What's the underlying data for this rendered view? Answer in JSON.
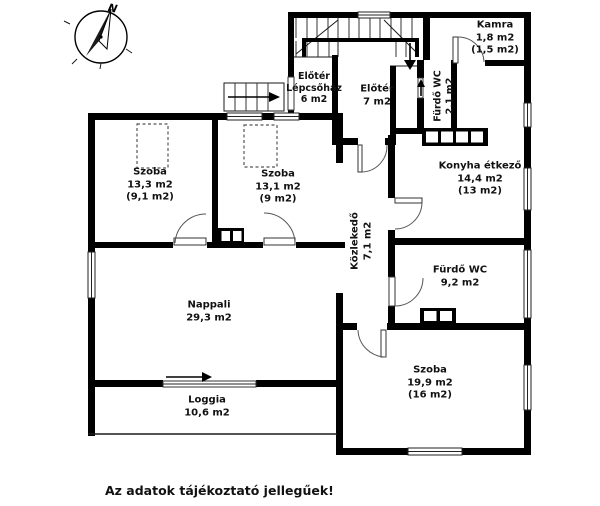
{
  "plan": {
    "compass": {
      "north_label": "N"
    },
    "rooms": {
      "szoba_133": {
        "name": "Szoba",
        "area": "13,3 m2",
        "reduced": "(9,1 m2)"
      },
      "szoba_131": {
        "name": "Szoba",
        "area": "13,1 m2",
        "reduced": "(9 m2)"
      },
      "eloter_lepcsohaz": {
        "name1": "Előtér",
        "name2": "Lépcsőház",
        "area": "6 m2"
      },
      "eloter": {
        "name": "Előtér",
        "area": "7 m2"
      },
      "kamra": {
        "name": "Kamra",
        "area": "1,8 m2",
        "reduced": "(1,5 m2)"
      },
      "furdo_wc_kis": {
        "name": "Fürdő WC",
        "area": "2,1 m2"
      },
      "konyha": {
        "name": "Konyha étkező",
        "area": "14,4 m2",
        "reduced": "(13 m2)"
      },
      "kozlekedo": {
        "name": "Közlekedő",
        "area": "7,1 m2"
      },
      "furdo_wc": {
        "name": "Fürdő WC",
        "area": "9,2 m2"
      },
      "nappali": {
        "name": "Nappali",
        "area": "29,3 m2"
      },
      "loggia": {
        "name": "Loggia",
        "area": "10,6 m2"
      },
      "szoba_199": {
        "name": "Szoba",
        "area": "19,9 m2",
        "reduced": "(16 m2)"
      }
    },
    "disclaimer": "Az adatok tájékoztató jellegűek!",
    "colors": {
      "wall": "#000000",
      "background": "#ffffff",
      "text": "#111111"
    }
  }
}
